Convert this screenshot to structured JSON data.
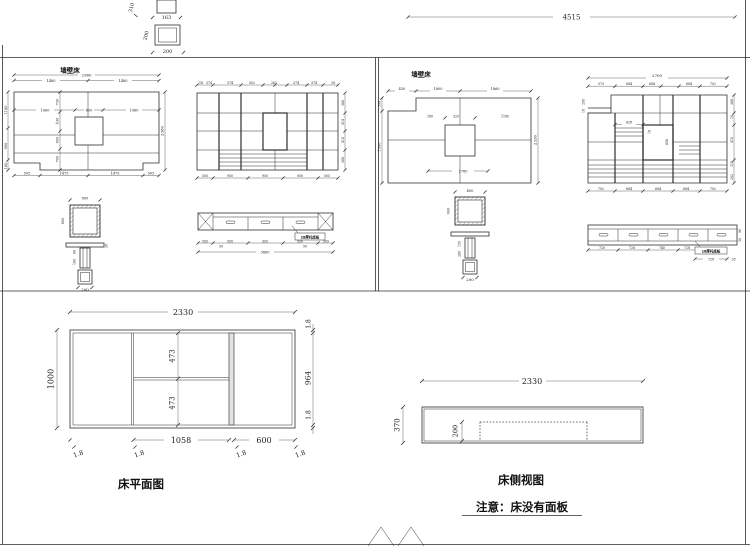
{
  "top": {
    "total": "4515",
    "col_h": "310",
    "col_w": "163",
    "sq_side": "200",
    "sq_bottom": "200"
  },
  "lu": {
    "title": "墙壁床",
    "plan_total": "2960",
    "plan_half_l": "1480",
    "plan_half_r": "1480",
    "plan_row": [
      "1060",
      "800",
      "1060"
    ],
    "plan_col": [
      "730",
      "430",
      "600",
      "700"
    ],
    "plan_left": [
      "1180",
      "950",
      "180"
    ],
    "plan_right": "2380",
    "plan_bottom": [
      "505",
      "1475",
      "1475",
      "505"
    ],
    "elev_top": [
      "18",
      "374",
      "374",
      "502",
      "262",
      "374",
      "374",
      "18"
    ],
    "elev_right": [
      "368",
      "414",
      "414",
      "368"
    ],
    "elev_bottom": [
      "505",
      "950",
      "950",
      "950",
      "505"
    ],
    "pillar_top": "800",
    "pillar_side": "800",
    "pillar_stem": [
      "60",
      "160"
    ],
    "pillar_slab": "30",
    "pillar_base": "200",
    "cab_label": "18厚托底板",
    "cab_chain": [
      "505",
      "950",
      "950",
      "950",
      "505"
    ],
    "cab_feet": [
      "50",
      "50"
    ],
    "cab_total": "3860"
  },
  "ru": {
    "title": "墙壁床",
    "plan_top": [
      "430",
      "1800",
      "1860"
    ],
    "plan_left": [
      "504",
      "1500"
    ],
    "plan_right": "2330",
    "plan_row": [
      "180",
      "320",
      "1180"
    ],
    "plan_bottom": "1780",
    "elev_total": "2700",
    "elev_top": [
      "573",
      "684",
      "684",
      "684",
      "702"
    ],
    "elev_bottom": [
      "702",
      "684",
      "684",
      "684",
      "702"
    ],
    "elev_right": [
      "368",
      "18",
      "410",
      "318",
      "202"
    ],
    "elev_left": [
      "208",
      "18"
    ],
    "niche_w": "628",
    "niche_h": "608",
    "niche_t": "18",
    "pillar_top": "400",
    "pillar_side": "600",
    "pillar_stem": [
      "150",
      "260"
    ],
    "pillar_base": "200",
    "cab_label": "18厚托底板",
    "cab_chain": [
      "720",
      "728",
      "740",
      "728"
    ],
    "cab_last": "728",
    "cab_end": "28",
    "cab_side": [
      "90",
      "30"
    ]
  },
  "bp": {
    "title": "床平面图",
    "w": "2330",
    "h": "1000",
    "ia": "473",
    "ib": "473",
    "rh": "964",
    "rt": "1.8",
    "rb": "1.8",
    "sa": "1058",
    "sb": "600",
    "ld": [
      "1.8",
      "1.8",
      "1.8",
      "1.8"
    ]
  },
  "bs": {
    "title": "床侧视图",
    "w": "2330",
    "h": "370",
    "ih": "200",
    "note": "注意：床没有面板"
  }
}
